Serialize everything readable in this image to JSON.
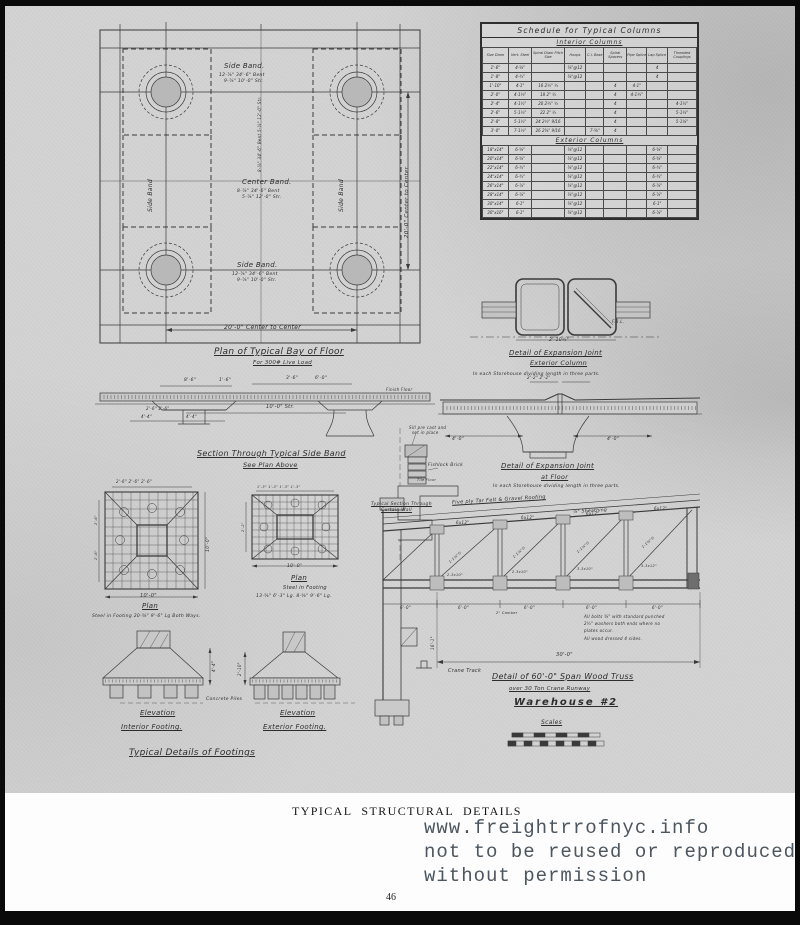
{
  "page": {
    "caption": "TYPICAL STRUCTURAL DETAILS",
    "number": "46"
  },
  "watermark": {
    "line1": "www.freightrrofnyc.info",
    "line2": "not to be reused or reproduced",
    "line3": "without permission"
  },
  "schedule": {
    "title": "Schedule for Typical Columns",
    "interior_label": "Interior Columns",
    "exterior_label": "Exterior Columns",
    "columns": [
      "Size Diam",
      "Vert. Steel",
      "Spiral Diam Pitch Size",
      "Hoops",
      "C.I. Base",
      "Spiral Spacers",
      "Pipe Splice",
      "Lap Splice",
      "Threaded Couplings"
    ],
    "interior_rows": [
      [
        "1'-6\"",
        "4-⅝\"",
        "",
        "⅜\"@12",
        "",
        "",
        "",
        "4",
        ""
      ],
      [
        "1'-8\"",
        "4-¾\"",
        "",
        "⅜\"@12",
        "",
        "",
        "",
        "4",
        ""
      ],
      [
        "1'-10\"",
        "4-1\"",
        "16 2½\" ½",
        "",
        "",
        "4",
        "4-1\"",
        "",
        ""
      ],
      [
        "2'-0\"",
        "4-1¼\"",
        "18 2\" ½",
        "",
        "",
        "4",
        "4-1¼\"",
        "",
        ""
      ],
      [
        "2'-4\"",
        "4-1½\"",
        "20 2¼\" ½",
        "",
        "",
        "4",
        "",
        "",
        "4-1½\""
      ],
      [
        "2'-6\"",
        "5-1¼\"",
        "22 2\" ½",
        "",
        "",
        "4",
        "",
        "",
        "5-1¼\""
      ],
      [
        "2'-8\"",
        "5-1½\"",
        "24 2¼\" 9/16",
        "",
        "",
        "4",
        "",
        "",
        "5-1⅛\""
      ],
      [
        "3'-0\"",
        "7-1¼\"",
        "26 2⅜\" 9/16",
        "",
        "7-⅝\"",
        "4",
        "",
        "",
        ""
      ]
    ],
    "exterior_rows": [
      [
        "18\"x14\"",
        "6-⅝\"",
        "",
        "⅜\"@12",
        "",
        "",
        "",
        "6-⅝\"",
        ""
      ],
      [
        "20\"x14\"",
        "6-⅝\"",
        "",
        "⅜\"@12",
        "",
        "",
        "",
        "6-⅝\"",
        ""
      ],
      [
        "22\"x14\"",
        "6-¾\"",
        "",
        "⅜\"@12",
        "",
        "",
        "",
        "6-¾\"",
        ""
      ],
      [
        "24\"x14\"",
        "6-¾\"",
        "",
        "⅜\"@12",
        "",
        "",
        "",
        "6-¾\"",
        ""
      ],
      [
        "26\"x14\"",
        "6-⅞\"",
        "",
        "⅜\"@12",
        "",
        "",
        "",
        "6-⅞\"",
        ""
      ],
      [
        "28\"x14\"",
        "6-⅞\"",
        "",
        "⅜\"@12",
        "",
        "",
        "",
        "6-⅞\"",
        ""
      ],
      [
        "30\"x14\"",
        "6-1\"",
        "",
        "⅜\"@12",
        "",
        "",
        "",
        "6-1\"",
        ""
      ],
      [
        "30\"x16\"",
        "6-1\"",
        "",
        "⅜\"@12",
        "",
        "",
        "",
        "6-⅞\"",
        ""
      ]
    ]
  },
  "plan_bay": {
    "side_band_top": "Side Band.",
    "side_band_top_note1": "12-⅞\" 34'-6\" Bent",
    "side_band_top_note2": "9-⅞\" 10'-0\" Str.",
    "center_band": "Center Band.",
    "center_band_note1": "8-⅞\" 34'-6\" Bent",
    "center_band_note2": "5-⅞\" 12'-0\" Str.",
    "side_band_bottom": "Side Band.",
    "side_band_bottom_note1": "12-⅞\" 34'-6\" Bent",
    "side_band_bottom_note2": "9-⅞\" 10'-0\" Str.",
    "side_band_vert_left": "Side Band",
    "side_band_vert_right": "Side Band",
    "vert_note": "8-⅞\" 34'-6\" Bent  5-⅞\" 12'-0\" Str.",
    "dim_bottom": "20'-0\" Center to Center",
    "dim_right": "20'-0\" Center to Center",
    "title": "Plan of Typical Bay of Floor",
    "subtitle": "For 300# Live Load"
  },
  "section_band": {
    "dim0": "8'-6\"",
    "dim1": "1'-6\"",
    "dim2": "3'-6\"",
    "dim3": "6'-0\"",
    "dim_str": "10'-0\" Str.",
    "dim_small": "2'-6\"  2'-6\"",
    "dim_44a": "4'-4\"",
    "dim_44b": "4'-4\"",
    "finish_floor": "Finish Floor",
    "title": "Section Through Typical Side Band",
    "subtitle": "See Plan Above"
  },
  "expansion_column": {
    "title1": "Detail of Expansion Joint",
    "title2": "Exterior Column",
    "note": "In each Storehouse dividing length in three parts.",
    "dim": "2'-10½\"",
    "fbl": "F.B.L."
  },
  "expansion_floor": {
    "title1": "Detail of Expansion Joint",
    "title2": "at Floor",
    "note": "In each Storehouse dividing length in three parts.",
    "dim_top": "2'-2\"  2'-2\"",
    "dim_left": "4'-0\"",
    "dim_right": "4'-0\""
  },
  "curtain_wall": {
    "sill_note1": "Sill pre cast and",
    "sill_note2": "set in place",
    "brick": "Fishlock Brick",
    "floor": "Tile Floor",
    "label1": "Typical Section Through",
    "label2": "Curtain Wall"
  },
  "footing_sq": {
    "dims_top": "2'-6\"  2'-6\"  2'-6\"",
    "dim_left1": "2'-6\"",
    "dim_left2": "2'-6\"",
    "dim_right": "10'-0\"",
    "dim_bottom": "10'-0\"",
    "plan": "Plan",
    "note": "Steel in Footing 20-⅝\" 9'-6\" Lg Both Ways."
  },
  "footing_rect": {
    "dims_top": "1'-3\" 1'-3\" 1'-3\" 1'-3\"",
    "dim_left": "2'-2\"",
    "dim_bottom": "10'-0\"",
    "plan": "Plan",
    "note1": "Steel in Footing",
    "note2": "13-⅝\" 6'-3\" Lg.   8-⅝\" 9'-6\" Lg."
  },
  "footing_elev": {
    "dim_int": "4'-4\"",
    "dim_ext": "2'-10\"",
    "piles": "Concrete Piles",
    "elev1a": "Elevation",
    "elev1b": "Interior Footing.",
    "elev2a": "Elevation",
    "elev2b": "Exterior Footing.",
    "title": "Typical Details of Footings"
  },
  "truss": {
    "roofing": "Five ply Tar Felt & Gravel Roofing",
    "sheathing": "⅞\" Sheathing",
    "purlin0": "6x12\"",
    "purlin1": "6x12\"",
    "purlin2": "6x12\"",
    "purlin3": "6x12\"",
    "diag0": "1-1⅛\"∅",
    "diag1": "1-1⅛\"∅",
    "diag2": "1-1⅛\"∅",
    "diag3": "1-1⅜\"∅",
    "bot0": "2-3x10\"",
    "bot1": "2-3x10\"",
    "bot2": "3-3x10\"",
    "bot3": "3-3x12\"",
    "pd0": "6'-0\"",
    "pd1": "6'-0\"",
    "pd2": "6'-0\"",
    "pd3": "6'-0\"",
    "pd4": "6'-0\"",
    "camber": "2\" Camber",
    "note1": "All bolts ⅝\" with standard punched",
    "note2": "2½\" washers both ends where no",
    "note3": "plates occur.",
    "note4": "All wood dressed 4 sides.",
    "span_dim": "30'-0\"",
    "height_dim": "16'-1\"",
    "crane": "Crane Track",
    "title1": "Detail of 60'-0\" Span Wood Truss",
    "title2": "over 30 Ton Crane Runway",
    "title3": "Warehouse #2",
    "scales": "Scales"
  }
}
